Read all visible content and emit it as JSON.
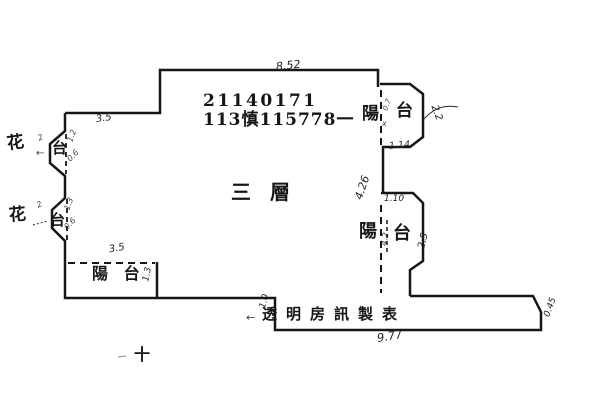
{
  "document": {
    "type": "floor-plan"
  },
  "colors": {
    "ink": "#161616",
    "background": "#ffffff"
  },
  "printed": {
    "registration_no": "21140171",
    "permit_no": "113慎115778一",
    "floor_label": "三 層",
    "maker_label": "透明房訊製表"
  },
  "room_labels": {
    "balcony_top_right_yang": "陽",
    "balcony_top_right_tai": "台",
    "balcony_mid_right_yang": "陽",
    "balcony_mid_right_tai": "台",
    "balcony_bottom_left": "陽 台",
    "flower_bed_1_hua": "花",
    "flower_bed_1_tai": "台",
    "flower_bed_2_hua": "花",
    "flower_bed_2_tai": "台"
  },
  "dimensions": {
    "top_width": "8.52",
    "upper_left_width": "3.5",
    "right_wall_height": "4.26",
    "balcony_top_right_width": "1.14",
    "balcony_top_right_side": "2.2",
    "balcony_mid_right_width": "1.10",
    "balcony_mid_right_side": "2.5",
    "balcony_mid_right_inner": "4.2",
    "balcony_bottom_left_width": "3.5",
    "balcony_bottom_left_depth": "1.3",
    "step_depth": "1.0",
    "bottom_width": "9.77",
    "corner_cut": "0.45",
    "flower_bed_1_marks": [
      "2",
      "1.2",
      "0.6"
    ],
    "flower_bed_2_marks": [
      "2",
      "1.3",
      "0.6"
    ],
    "balcony_top_right_marks": [
      "0.7",
      "x"
    ]
  },
  "symbols": {
    "cross_mark": "十",
    "arrow_left": "←",
    "small_tick": "-"
  }
}
